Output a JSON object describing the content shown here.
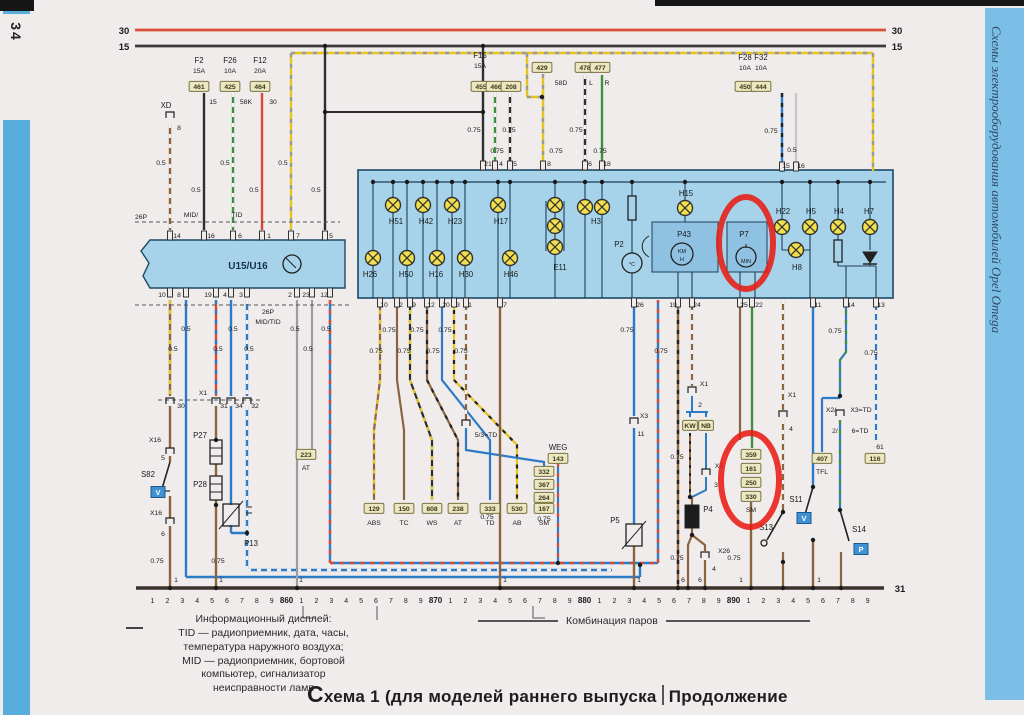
{
  "page_number": "34",
  "side_title": "Схемы электрооборудования автомобилей Opel Omega",
  "footer": {
    "legend_lines": [
      "Информационный дисплей:",
      "TID — радиоприемник, дата, часы,",
      "температура наружного воздуха;",
      "MID — радиоприемник, бортовой",
      "компьютер, сигнализатор",
      "неисправности ламп"
    ],
    "cluster_caption": "Комбинация паров",
    "title_left": "Схема 1 (для моделей раннего выпуска",
    "title_right": "Продолжение"
  },
  "colors": {
    "annotation_red": "#e81d15",
    "panel_blue": "#a6d3ea",
    "strip_blue": "#57aedd",
    "bus30_red": "#d94f38",
    "designation_box": "#ece7c3"
  },
  "diagram": {
    "scale": [
      "1",
      "2",
      "3",
      "4",
      "5",
      "6",
      "7",
      "8",
      "9",
      "860",
      "1",
      "2",
      "3",
      "4",
      "5",
      "6",
      "7",
      "8",
      "9",
      "870",
      "1",
      "2",
      "3",
      "4",
      "5",
      "6",
      "7",
      "8",
      "9",
      "880",
      "1",
      "2",
      "3",
      "4",
      "5",
      "6",
      "7",
      "8",
      "9",
      "890",
      "1",
      "2",
      "3",
      "4",
      "5",
      "6",
      "7",
      "8",
      "9"
    ],
    "labels": [
      [
        "30",
        124,
        34,
        "bus"
      ],
      [
        "15",
        124,
        50,
        "bus"
      ],
      [
        "30",
        897,
        34,
        "bus"
      ],
      [
        "15",
        897,
        50,
        "bus"
      ],
      [
        "31",
        900,
        592,
        "bus"
      ],
      [
        "F2",
        199,
        63,
        "id"
      ],
      [
        "F26",
        230,
        63,
        "id"
      ],
      [
        "F12",
        260,
        63,
        "id"
      ],
      [
        "15A",
        199,
        73
      ],
      [
        "10A",
        230,
        73
      ],
      [
        "20A",
        260,
        73
      ],
      [
        "461",
        199,
        89,
        "box"
      ],
      [
        "425",
        230,
        89,
        "box"
      ],
      [
        "464",
        260,
        89,
        "box"
      ],
      [
        "15",
        213,
        104
      ],
      [
        "58K",
        246,
        104
      ],
      [
        "30",
        273,
        104
      ],
      [
        "XD",
        166,
        108,
        "id"
      ],
      [
        "8",
        179,
        130
      ],
      [
        "F15",
        480,
        58,
        "id"
      ],
      [
        "15A",
        480,
        68
      ],
      [
        "455",
        481,
        89,
        "box"
      ],
      [
        "466",
        496,
        89,
        "box"
      ],
      [
        "208",
        511,
        89,
        "box"
      ],
      [
        "429",
        542,
        70,
        "box"
      ],
      [
        "58D",
        561,
        85
      ],
      [
        "478",
        585,
        70,
        "box"
      ],
      [
        "477",
        600,
        70,
        "box"
      ],
      [
        "L",
        591,
        85
      ],
      [
        "R",
        607,
        85
      ],
      [
        "F28",
        745,
        60,
        "id"
      ],
      [
        "F32",
        761,
        60,
        "id"
      ],
      [
        "10A",
        745,
        70
      ],
      [
        "10A",
        761,
        70
      ],
      [
        "450",
        745,
        89,
        "box"
      ],
      [
        "444",
        761,
        89,
        "box"
      ],
      [
        "0.5",
        161,
        165
      ],
      [
        "0.5",
        196,
        192
      ],
      [
        "0.5",
        225,
        165
      ],
      [
        "0.5",
        254,
        192
      ],
      [
        "0.5",
        283,
        165
      ],
      [
        "0.5",
        316,
        192
      ],
      [
        "0.75",
        474,
        132
      ],
      [
        "0.75",
        509,
        132
      ],
      [
        "0.75",
        497,
        153
      ],
      [
        "0.75",
        556,
        153
      ],
      [
        "0.75",
        576,
        132
      ],
      [
        "0.75",
        600,
        153
      ],
      [
        "0.75",
        771,
        133
      ],
      [
        "0.5",
        792,
        152
      ],
      [
        "26P",
        141,
        219
      ],
      [
        "MID/",
        191,
        217
      ],
      [
        "TID",
        237,
        217
      ],
      [
        "14",
        177,
        238
      ],
      [
        "16",
        211,
        238
      ],
      [
        "6",
        240,
        238
      ],
      [
        "1",
        269,
        238
      ],
      [
        "7",
        298,
        238
      ],
      [
        "5",
        331,
        238
      ],
      [
        "U15/U16",
        248,
        269,
        "id2"
      ],
      [
        "10",
        162,
        297
      ],
      [
        "8",
        179,
        297
      ],
      [
        "19",
        208,
        297
      ],
      [
        "4",
        225,
        297
      ],
      [
        "3",
        241,
        297
      ],
      [
        "2",
        290,
        297
      ],
      [
        "23",
        306,
        297
      ],
      [
        "12",
        324,
        297
      ],
      [
        "26P",
        268,
        314
      ],
      [
        "MID/TID",
        268,
        324
      ],
      [
        "0.5",
        186,
        331
      ],
      [
        "0.5",
        233,
        331
      ],
      [
        "0.5",
        295,
        331
      ],
      [
        "0.5",
        326,
        331
      ],
      [
        "0.5",
        173,
        351
      ],
      [
        "0.5",
        218,
        351
      ],
      [
        "0.5",
        249,
        351
      ],
      [
        "0.5",
        308,
        351
      ],
      [
        "21",
        488,
        166
      ],
      [
        "4",
        501,
        166
      ],
      [
        "5",
        515,
        166
      ],
      [
        "8",
        549,
        166
      ],
      [
        "6",
        590,
        166
      ],
      [
        "18",
        607,
        166
      ],
      [
        "15",
        786,
        168
      ],
      [
        "16",
        801,
        168
      ],
      [
        "H51",
        396,
        224,
        "id"
      ],
      [
        "H42",
        426,
        224,
        "id"
      ],
      [
        "H23",
        455,
        224,
        "id"
      ],
      [
        "H17",
        501,
        224,
        "id"
      ],
      [
        "H26",
        370,
        277,
        "id"
      ],
      [
        "H50",
        406,
        277,
        "id"
      ],
      [
        "H16",
        436,
        277,
        "id"
      ],
      [
        "H30",
        466,
        277,
        "id"
      ],
      [
        "H46",
        511,
        277,
        "id"
      ],
      [
        "E11",
        560,
        270,
        "id"
      ],
      [
        "H3",
        596,
        224,
        "id"
      ],
      [
        "H15",
        686,
        196,
        "id"
      ],
      [
        "H22",
        783,
        214,
        "id"
      ],
      [
        "H5",
        811,
        214,
        "id"
      ],
      [
        "H4",
        839,
        214,
        "id"
      ],
      [
        "H7",
        869,
        214,
        "id"
      ],
      [
        "H8",
        797,
        270,
        "id"
      ],
      [
        "P2",
        619,
        247,
        "id"
      ],
      [
        "°C",
        632,
        266,
        "tiny"
      ],
      [
        "P43",
        684,
        237,
        "id"
      ],
      [
        "KM",
        682,
        253,
        "tiny"
      ],
      [
        "H",
        682,
        261,
        "tiny"
      ],
      [
        "P7",
        744,
        237,
        "id"
      ],
      [
        "MIN",
        746,
        263,
        "tiny"
      ],
      [
        "10",
        384,
        307
      ],
      [
        "2",
        401,
        307
      ],
      [
        "9",
        414,
        307
      ],
      [
        "12",
        431,
        307
      ],
      [
        "20",
        446,
        307
      ],
      [
        "3",
        458,
        307
      ],
      [
        "1",
        470,
        307
      ],
      [
        "7",
        505,
        307
      ],
      [
        "26",
        640,
        307
      ],
      [
        "19",
        673,
        307
      ],
      [
        "24",
        697,
        307
      ],
      [
        "25",
        744,
        307
      ],
      [
        "22",
        759,
        307
      ],
      [
        "11",
        818,
        307
      ],
      [
        "14",
        851,
        307
      ],
      [
        "13",
        881,
        307
      ],
      [
        "0.75",
        389,
        332
      ],
      [
        "0.75",
        417,
        332
      ],
      [
        "0.75",
        445,
        332
      ],
      [
        "0.75",
        376,
        353
      ],
      [
        "0.75",
        404,
        353
      ],
      [
        "0.75",
        433,
        353
      ],
      [
        "0.75",
        461,
        353
      ],
      [
        "0.75",
        627,
        332
      ],
      [
        "0.75",
        661,
        353
      ],
      [
        "0.75",
        835,
        333
      ],
      [
        "0.75",
        871,
        355
      ],
      [
        "X1",
        203,
        395
      ],
      [
        "30",
        181,
        408
      ],
      [
        "31",
        224,
        408
      ],
      [
        "34",
        239,
        408
      ],
      [
        "32",
        255,
        408
      ],
      [
        "X16",
        155,
        442
      ],
      [
        "5",
        163,
        460
      ],
      [
        "S82",
        148,
        477,
        "id"
      ],
      [
        "X16",
        156,
        515
      ],
      [
        "6",
        163,
        536
      ],
      [
        "P27",
        200,
        438,
        "id"
      ],
      [
        "P28",
        200,
        487,
        "id"
      ],
      [
        "P13",
        251,
        546,
        "id"
      ],
      [
        "223",
        306,
        457,
        "box"
      ],
      [
        "AT",
        306,
        470
      ],
      [
        "5/3=TD",
        486,
        437
      ],
      [
        "129",
        374,
        511,
        "box"
      ],
      [
        "150",
        404,
        511,
        "box"
      ],
      [
        "808",
        432,
        511,
        "box"
      ],
      [
        "238",
        458,
        511,
        "box"
      ],
      [
        "333",
        490,
        511,
        "box"
      ],
      [
        "530",
        517,
        511,
        "box"
      ],
      [
        "167",
        544,
        511,
        "box"
      ],
      [
        "332",
        544,
        474,
        "box"
      ],
      [
        "367",
        544,
        487,
        "box"
      ],
      [
        "264",
        544,
        500,
        "box"
      ],
      [
        "ABS",
        374,
        525
      ],
      [
        "TC",
        404,
        525
      ],
      [
        "WS",
        432,
        525
      ],
      [
        "AT",
        458,
        525
      ],
      [
        "TD",
        490,
        525
      ],
      [
        "AB",
        517,
        525
      ],
      [
        "SM",
        544,
        525
      ],
      [
        "0.75",
        487,
        519
      ],
      [
        "WEG",
        558,
        450,
        "id"
      ],
      [
        "143",
        558,
        461,
        "box"
      ],
      [
        "0.75",
        544,
        521
      ],
      [
        "X3",
        644,
        418
      ],
      [
        "11",
        641,
        436
      ],
      [
        "P5",
        615,
        523,
        "id"
      ],
      [
        "1",
        639,
        582
      ],
      [
        "X1",
        704,
        386
      ],
      [
        "2",
        700,
        407
      ],
      [
        "KW",
        690,
        428,
        "box"
      ],
      [
        "NB",
        706,
        428,
        "box"
      ],
      [
        "0.75",
        677,
        459
      ],
      [
        "X6",
        719,
        468
      ],
      [
        "3",
        716,
        487
      ],
      [
        "P4",
        708,
        512,
        "id"
      ],
      [
        "0.75",
        677,
        560
      ],
      [
        "X26",
        724,
        553
      ],
      [
        "4",
        714,
        571
      ],
      [
        "6",
        683,
        582
      ],
      [
        "6",
        700,
        582
      ],
      [
        "359",
        751,
        457,
        "box"
      ],
      [
        "161",
        751,
        471,
        "box"
      ],
      [
        "250",
        751,
        485,
        "box"
      ],
      [
        "330",
        751,
        499,
        "box"
      ],
      [
        "SM",
        751,
        512
      ],
      [
        "0.75",
        734,
        560
      ],
      [
        "1",
        741,
        582
      ],
      [
        "X1",
        792,
        397
      ],
      [
        "4",
        791,
        431
      ],
      [
        "S13",
        766,
        530,
        "id"
      ],
      [
        "S11",
        796,
        502,
        "id"
      ],
      [
        "1",
        819,
        582
      ],
      [
        "X2/",
        831,
        412
      ],
      [
        "X3=TD",
        861,
        412
      ],
      [
        "2/",
        835,
        433
      ],
      [
        "6=TD",
        860,
        433
      ],
      [
        "S14",
        859,
        532,
        "id"
      ],
      [
        "407",
        822,
        461,
        "box"
      ],
      [
        "TFL",
        822,
        474
      ],
      [
        "61",
        880,
        449
      ],
      [
        "116",
        875,
        461,
        "box"
      ],
      [
        "0.75",
        157,
        563
      ],
      [
        "0.75",
        218,
        563
      ],
      [
        "1",
        176,
        582
      ],
      [
        "1",
        221,
        582
      ],
      [
        "1",
        301,
        582
      ],
      [
        "1",
        505,
        582
      ],
      [
        "V",
        158,
        495,
        "vbox"
      ],
      [
        "V",
        804,
        521,
        "vbox"
      ],
      [
        "P",
        861,
        552,
        "vbox"
      ]
    ]
  }
}
